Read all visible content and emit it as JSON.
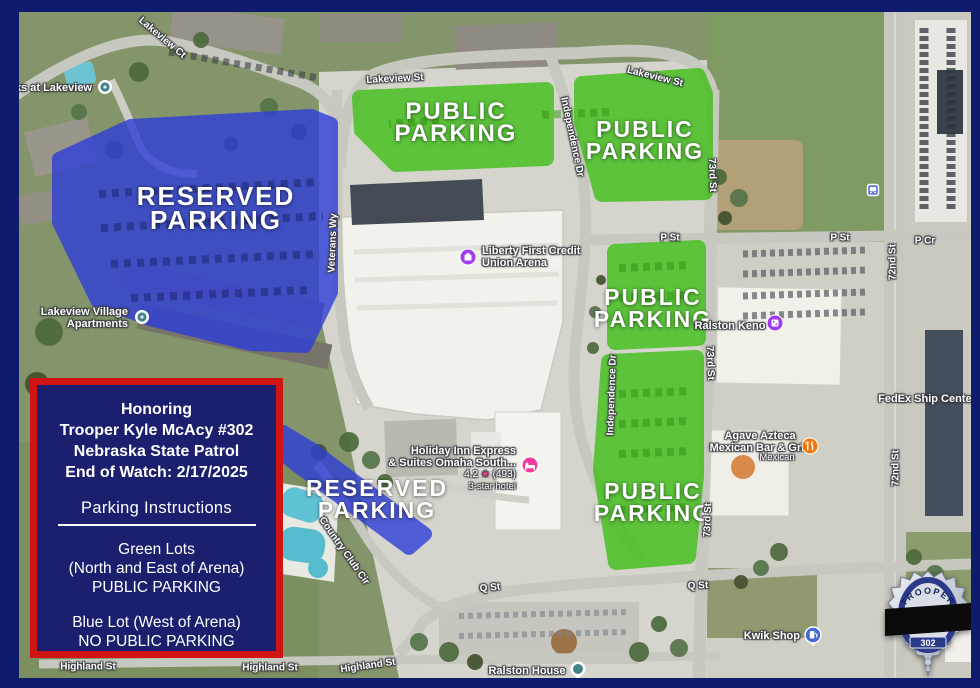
{
  "map": {
    "zone_labels": {
      "public": {
        "line1": "PUBLIC",
        "line2": "PARKING"
      },
      "reserved": {
        "line1": "RESERVED",
        "line2": "PARKING"
      }
    },
    "streets": {
      "lakeview_ct": "Lakeview Ct",
      "lakeview_st": "Lakeview St",
      "independence_dr": "Independence Dr",
      "veterans_wy": "Veterans Wy",
      "st_73rd": "73rd St",
      "st_72nd": "72nd St",
      "p_st": "P St",
      "p_cir": "P Cr",
      "q_st": "Q St",
      "country_club_cir": "Country Club Cir",
      "highland_st": "Highland St"
    },
    "pois": {
      "oaks": {
        "label": "Oaks at Lakeview"
      },
      "lakeview_village": {
        "line1": "Lakeview Village",
        "line2": "Apartments"
      },
      "arena": {
        "line1": "Liberty First Credit",
        "line2": "Union Arena"
      },
      "holiday_inn": {
        "line1": "Holiday Inn Express",
        "line2": "& Suites Omaha South...",
        "rating": "4.2",
        "star": "★",
        "reviews": "(493)",
        "category": "3-star hotel"
      },
      "ralston_keno": {
        "label": "Ralston Keno"
      },
      "agave": {
        "line1": "Agave Azteca",
        "line2": "Mexican Bar & Grill",
        "category": "Mexican"
      },
      "fedex": {
        "label": "FedEx Ship Center"
      },
      "kwik_shop": {
        "label": "Kwik Shop"
      },
      "ralston_house": {
        "label": "Ralston House"
      }
    }
  },
  "memorial": {
    "honoring": "Honoring",
    "name": "Trooper Kyle McAcy #302",
    "agency": "Nebraska State Patrol",
    "eow": "End of Watch: 2/17/2025",
    "instructions_title": "Parking Instructions",
    "green": {
      "line1": "Green Lots",
      "line2": "(North and East of Arena)",
      "line3": "PUBLIC PARKING"
    },
    "blue": {
      "line1": "Blue Lot (West of Arena)",
      "line2": "NO PUBLIC PARKING"
    }
  },
  "badge": {
    "rank": "TROOPER",
    "number": "302"
  },
  "colors": {
    "frame_navy": "#0f1b6c",
    "memorial_navy": "#1b1f6e",
    "memorial_red": "#d01414",
    "public_green": "#3fbf17",
    "reserved_blue": "#2e3ed8"
  }
}
